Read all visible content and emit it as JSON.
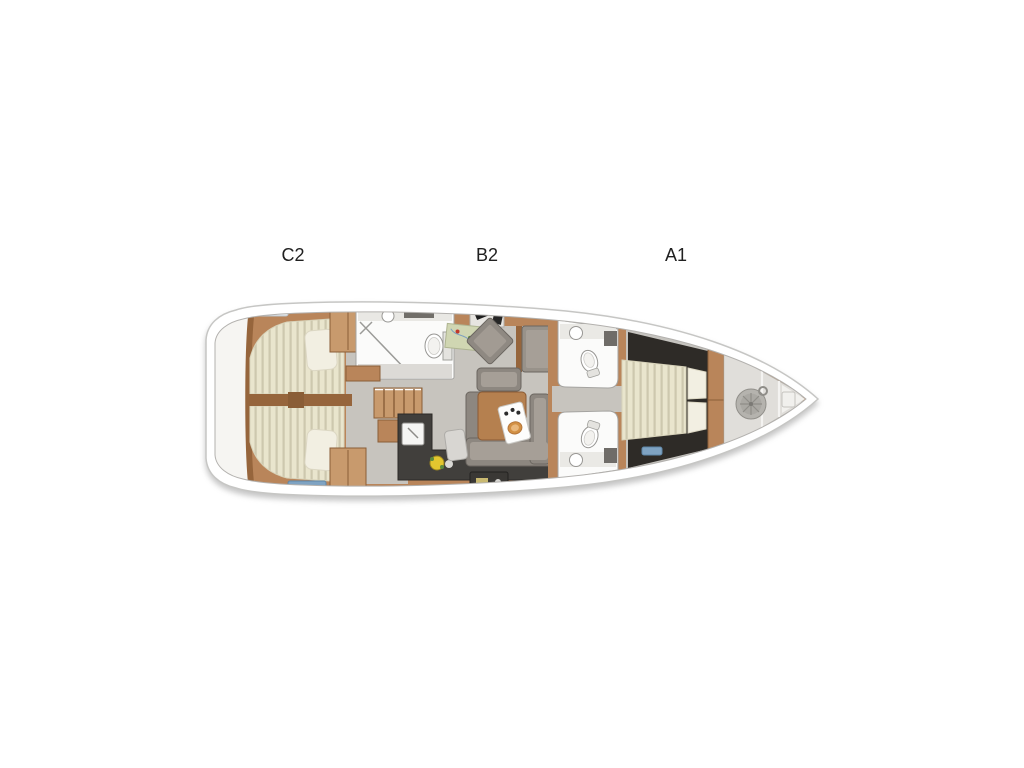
{
  "figure": {
    "kind": "yacht interior layout floor plan, bow pointing right",
    "visible_text_only": [
      "C2",
      "B2",
      "A1"
    ]
  },
  "cabin_labels": [
    {
      "text": "C2",
      "area": "aft-cabin"
    },
    {
      "text": "B2",
      "area": "salon"
    },
    {
      "text": "A1",
      "area": "forward-cabin"
    }
  ],
  "palette": {
    "background": "#ffffff",
    "hull_stroke": "#c6c6c4",
    "deck_white": "#f6f5f2",
    "wood": "#b9855a",
    "wood_dark": "#96653c",
    "wood_light": "#c89a6d",
    "wood_line": "#8a5e38",
    "floor_gray": "#c7c4be",
    "floor_dark": "#2e2b27",
    "counter_dark": "#413f3c",
    "mattress": "#e9e5cd",
    "mattress_stripe": "#cdc8ae",
    "pillow": "#f2efe2",
    "sofa": "#8d8780",
    "sofa_light": "#a69f97",
    "fixture_white": "#fbfbfa",
    "hatch_blue": "#7fa3c2",
    "flower_yellow": "#e3c62f",
    "windlass_gray": "#b5b3ae"
  },
  "icons": [
    "double-bed-icon",
    "pillow-icon",
    "wardrobe-icon",
    "deck-hatch-icon",
    "shower-screen-icon",
    "washbasin-icon",
    "toilet-icon",
    "companionway-stairs-icon",
    "galley-counter-icon",
    "galley-sink-icon",
    "flower-vase-icon",
    "nav-desk-icon",
    "laptop-icon",
    "chart-map-icon",
    "swivel-chair-icon",
    "bench-seat-icon",
    "u-sofa-icon",
    "ottoman-icon",
    "salon-table-icon",
    "serving-tray-icon",
    "anchor-windlass-icon",
    "bow-step-icon",
    "swim-platform-icon"
  ]
}
